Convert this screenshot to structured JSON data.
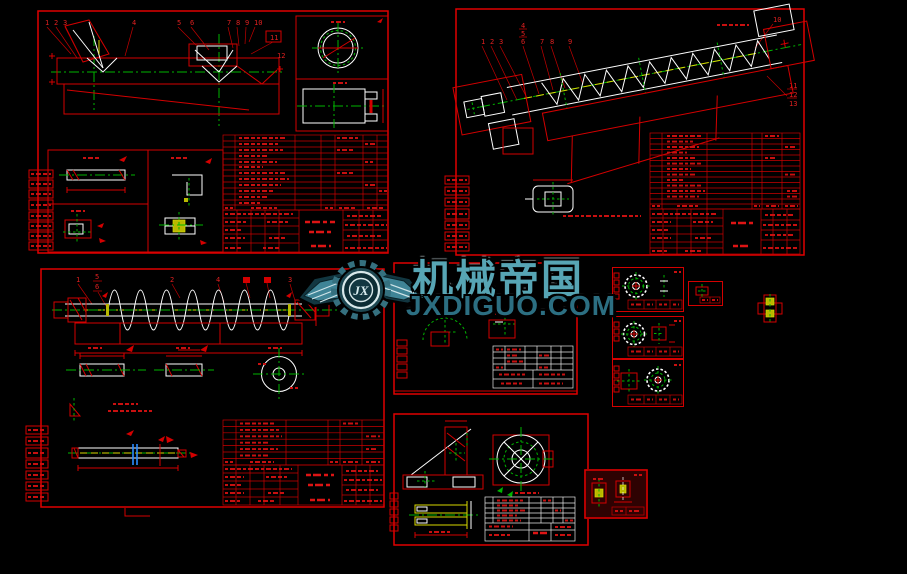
{
  "watermark": {
    "brand": "机械帝国",
    "domain": "JXDIGUO.COM",
    "monogram": "JX"
  },
  "sheets": {
    "trough": {
      "callouts": [
        "1",
        "2",
        "3",
        "4",
        "5",
        "6",
        "7",
        "8",
        "9",
        "10",
        "11",
        "12"
      ]
    },
    "conveyor": {
      "callouts_top": [
        "1",
        "2",
        "3",
        "4",
        "5",
        "6",
        "7",
        "8",
        "9"
      ],
      "callout_tr": "10",
      "callouts_right": [
        "11",
        "12",
        "13"
      ]
    },
    "shaft": {
      "callouts": [
        "1",
        "5",
        "6",
        "2",
        "4",
        "3"
      ]
    }
  },
  "colors": {
    "background": "#000000",
    "sheet_line": "#d40000",
    "detail_line": "#ffffff",
    "centerline": "#00b400",
    "highlight": "#d8d800",
    "section_mark": "#2a8cff",
    "brand_teal": "#57a5b4",
    "domain_teal": "#2c6f82"
  }
}
